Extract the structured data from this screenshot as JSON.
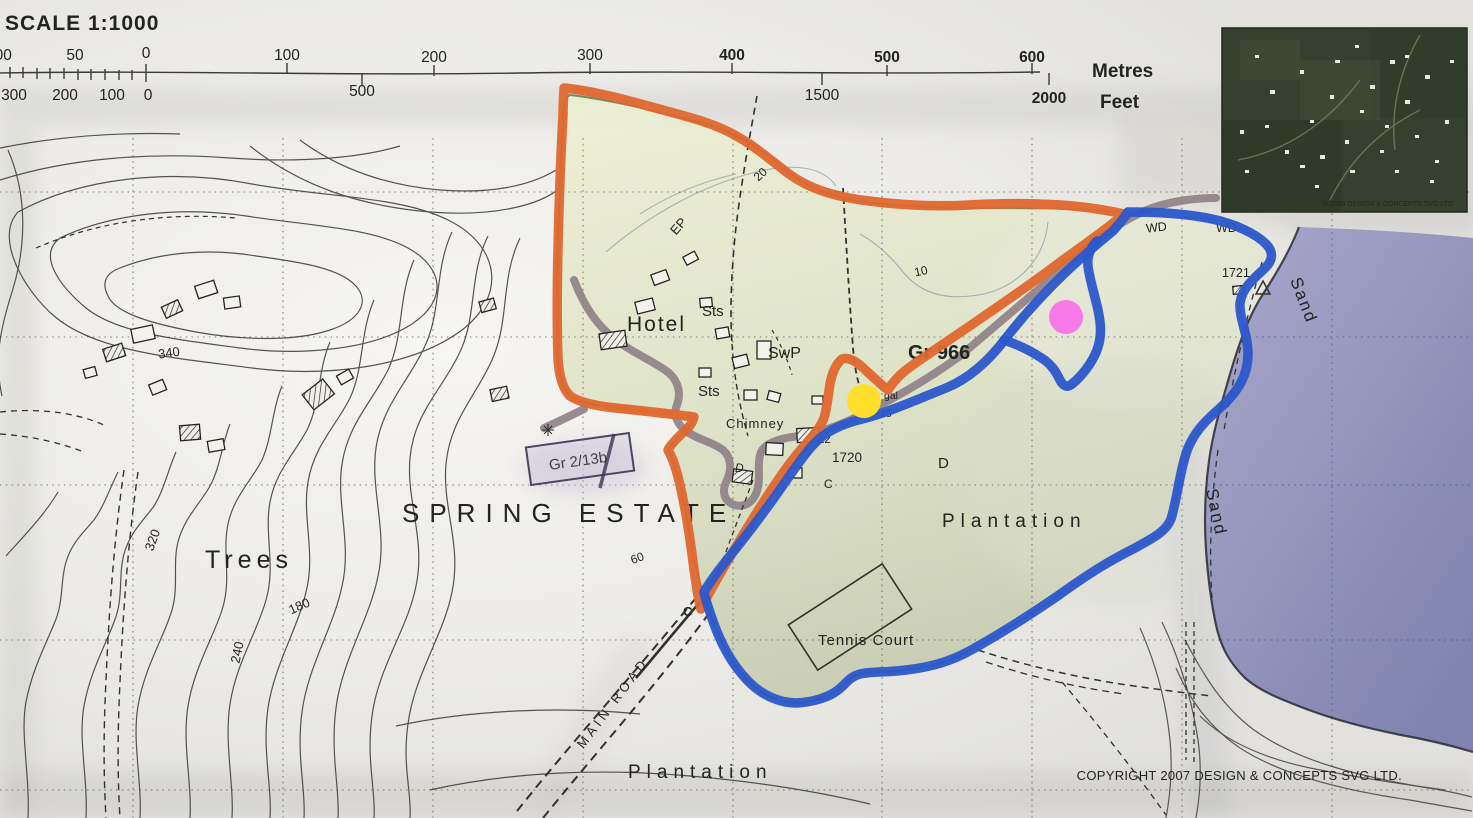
{
  "scale_bar": {
    "title": "SCALE 1:1000",
    "metres_unit": "Metres",
    "feet_unit": "Feet",
    "metres_left": [
      "100",
      "50",
      "0"
    ],
    "metres_main": [
      "100",
      "200",
      "300",
      "400",
      "500",
      "600"
    ],
    "feet_left": [
      "300",
      "200",
      "100",
      "0"
    ],
    "feet_main": [
      "500",
      "1500",
      "2000"
    ]
  },
  "labels": {
    "estate": "SPRING ESTATE",
    "trees": "Trees",
    "plantation_east": "Plantation",
    "plantation_south": "Plantation",
    "hotel": "Hotel",
    "sts_upper": "Sts",
    "sts_lower": "Sts",
    "swp": "SwP",
    "chimney": "Chimney",
    "ep": "EP",
    "tennis_court": "Tennis Court",
    "main_road": "MAIN  ROAD",
    "sand_north": "Sand",
    "sand_south": "Sand",
    "wd_west": "WD",
    "wd_east": "WD",
    "grid_ref": "Gr 966",
    "stamp": "Gr 2/13b",
    "spot_1721": "1721",
    "spot_1720": "1720",
    "spot_12": "12",
    "frag_gal": "gal",
    "frag_45": "45",
    "letter_d_road": "D",
    "letter_d_plantation": "D",
    "letter_c_road": "C",
    "letter_c_tip": "C"
  },
  "contour_labels": {
    "c340": "340",
    "c320": "320",
    "c240": "240",
    "c180": "180",
    "c60": "60",
    "c20": "20",
    "c10": "10"
  },
  "credits": {
    "copyright": "COPYRIGHT 2007 DESIGN & CONCEPTS SVG LTD.",
    "inset_caption": "© 2006 DESIGN & CONCEPTS SVG LTD"
  },
  "annotations": {
    "route_orange": "#df672e",
    "route_blue": "#2b57cb",
    "dot_yellow": "#ffdf2b",
    "dot_magenta": "#f87ae8",
    "highlight_yellow": "#f2c53d",
    "grid_ref_color": "#3f5c10"
  },
  "colors": {
    "sea_light": "#aaa7cb",
    "sea_deep": "#8083af",
    "estate_tint_top": "#edefd3",
    "estate_tint_bottom": "#c6ccb1",
    "estate_boundary": "#2f5a26",
    "road_grey": "#8b7d85",
    "ink": "#1f1f1f"
  }
}
